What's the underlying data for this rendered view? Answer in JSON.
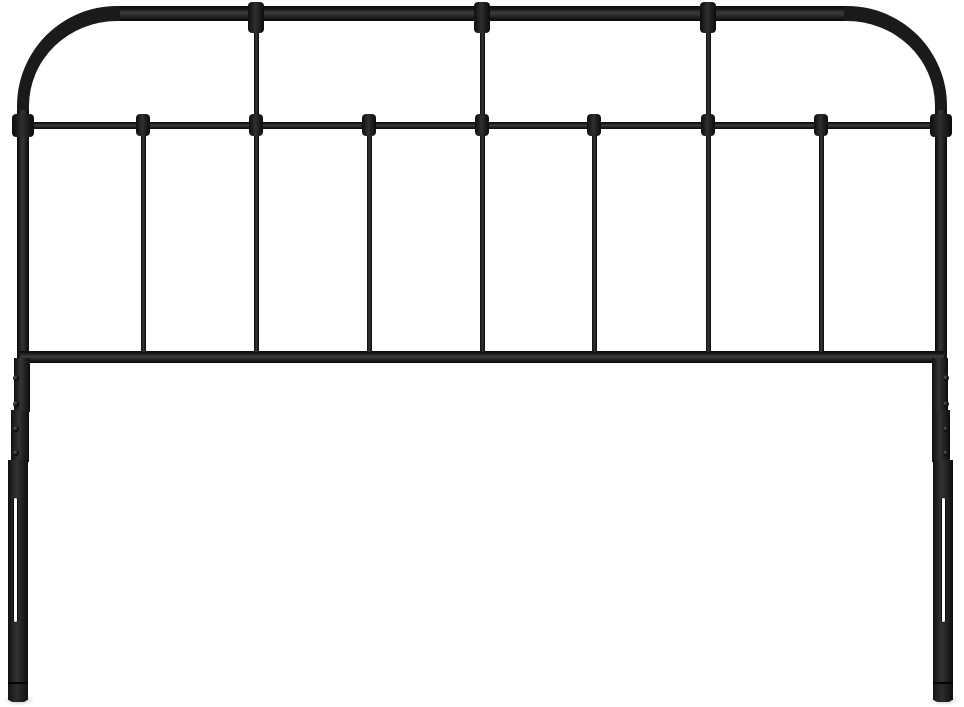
{
  "scene": {
    "description": "Product photo of a black metal spindle headboard on a plain white background. Rounded top corners, one thick top rail, a thin middle rail with round collar fittings, seven vertical spindles, a flat bottom rail, and two telescoping legs with adjustment holes and slots.",
    "object": "metal headboard",
    "finish": "matte black",
    "background_color": "#ffffff"
  },
  "colors": {
    "metal_dark": "#0a0a0a",
    "metal_mid": "#1f1f1f",
    "metal_highlight": "#3d3d3d",
    "shadow": "rgba(0,0,0,0.22)"
  },
  "structure": {
    "canvas": {
      "w": 964,
      "h": 707
    },
    "arch": {
      "x": 17,
      "y": 6,
      "w": 930,
      "h": 356,
      "top_thickness": 15,
      "side_thickness": 12,
      "corner_radius": 100
    },
    "top_rail_overlay": {
      "x": 120,
      "y": 6,
      "w": 724,
      "h": 15
    },
    "leg_overlay": {
      "y": 110,
      "h": 252,
      "w": 12,
      "left_x": 17,
      "right_x": 935
    },
    "mid_rail": {
      "x": 29,
      "y": 122,
      "w": 906,
      "h": 7
    },
    "bottom_rail": {
      "x": 20,
      "y": 351,
      "w": 924,
      "h": 12
    },
    "top_spindles_x": [
      256,
      482,
      708
    ],
    "lower_spindles_x": [
      143,
      256,
      369,
      482,
      594,
      708,
      821
    ],
    "spindle_w": 5,
    "top_spindle": {
      "y": 19,
      "h": 104
    },
    "lower_spindle": {
      "y": 127,
      "h": 225
    },
    "top_collar": {
      "w": 16,
      "y": 2,
      "h": 31
    },
    "mid_collar": {
      "w": 14,
      "y": 114,
      "h": 22
    },
    "leg_collars": [
      {
        "x": 12,
        "y": 114,
        "w": 22,
        "h": 23
      },
      {
        "x": 930,
        "y": 114,
        "w": 22,
        "h": 23
      }
    ],
    "left_sleeves": [
      {
        "x": 14,
        "y": 358,
        "w": 16,
        "h": 54
      },
      {
        "x": 11,
        "y": 410,
        "w": 18,
        "h": 52
      },
      {
        "x": 8,
        "y": 460,
        "w": 20,
        "h": 240
      }
    ],
    "right_sleeves": [
      {
        "x": 932,
        "y": 358,
        "w": 16,
        "h": 54
      },
      {
        "x": 932,
        "y": 410,
        "w": 18,
        "h": 52
      },
      {
        "x": 933,
        "y": 460,
        "w": 20,
        "h": 240
      }
    ],
    "holes_y": [
      375,
      401,
      426,
      450
    ],
    "hole_x": {
      "left": 13,
      "right": 943
    },
    "slots": [
      {
        "x": 13,
        "y": 497,
        "w": 5,
        "h": 126
      },
      {
        "x": 941,
        "y": 497,
        "w": 5,
        "h": 126
      }
    ],
    "feet": [
      {
        "x": 8,
        "y": 682,
        "w": 20,
        "h": 18
      },
      {
        "x": 933,
        "y": 682,
        "w": 20,
        "h": 18
      }
    ],
    "foot_shadows": [
      {
        "x": 3,
        "y": 694,
        "w": 32,
        "h": 12
      },
      {
        "x": 928,
        "y": 694,
        "w": 32,
        "h": 12
      }
    ]
  }
}
